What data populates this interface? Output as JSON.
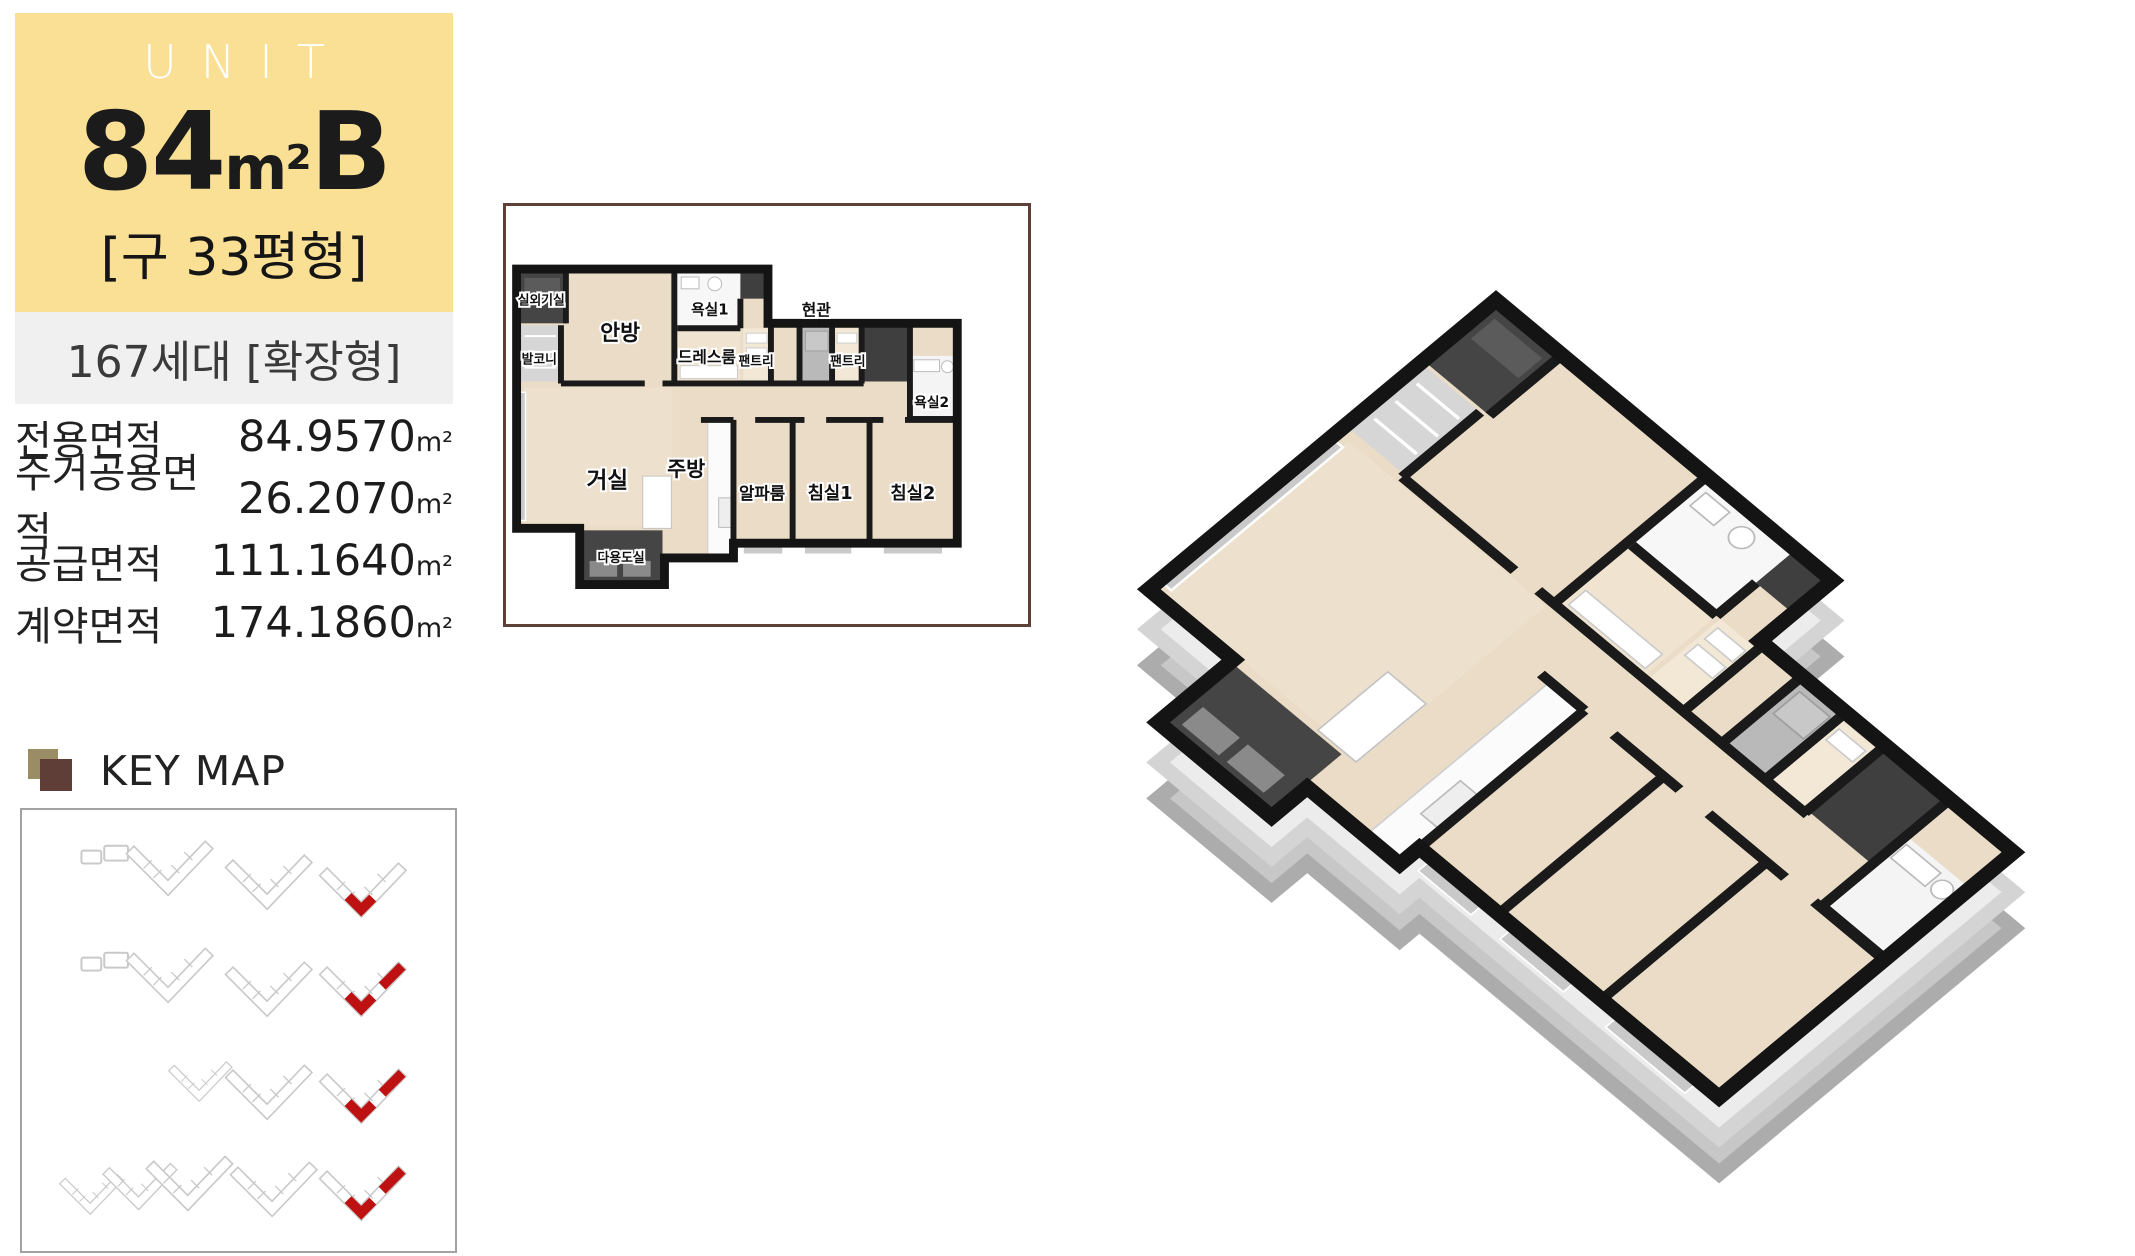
{
  "unit_panel": {
    "header": {
      "eyebrow": "UNIT",
      "size_number": "84",
      "size_unit": "m²",
      "type_letter": "B",
      "legacy_size": "[구 33평형]",
      "bg_color": "#F9E095"
    },
    "households_band": {
      "text": "167세대 [확장형]",
      "bg_color": "#F0F0F0"
    },
    "area_table": {
      "rows": [
        {
          "label": "전용면적",
          "value": "84.9570",
          "unit": "m²"
        },
        {
          "label": "주거공용면적",
          "value": "26.2070",
          "unit": "m²"
        },
        {
          "label": "공급면적",
          "value": "111.1640",
          "unit": "m²"
        },
        {
          "label": "계약면적",
          "value": "174.1860",
          "unit": "m²"
        }
      ]
    }
  },
  "key_map": {
    "title": "KEY MAP",
    "highlight_color": "#BE1212",
    "outline_color": "#C9C9C9",
    "icon_back_color": "#9A8D65",
    "icon_front_color": "#5F3E38"
  },
  "floor_plan_2d": {
    "border_color": "#5D4037",
    "rooms": [
      {
        "label": "실외기실"
      },
      {
        "label": "발코니"
      },
      {
        "label": "안방"
      },
      {
        "label": "욕실1"
      },
      {
        "label": "드레스룸"
      },
      {
        "label": "팬트리"
      },
      {
        "label": "현관"
      },
      {
        "label": "팬트리"
      },
      {
        "label": "욕실2"
      },
      {
        "label": "거실"
      },
      {
        "label": "주방"
      },
      {
        "label": "알파룸"
      },
      {
        "label": "침실1"
      },
      {
        "label": "침실2"
      },
      {
        "label": "다용도실"
      }
    ]
  },
  "floor_plan_3d": {
    "wall_cap_color": "#141414",
    "floor_color": "#EADCC6",
    "slab_side_color": "#C7C7C7"
  }
}
